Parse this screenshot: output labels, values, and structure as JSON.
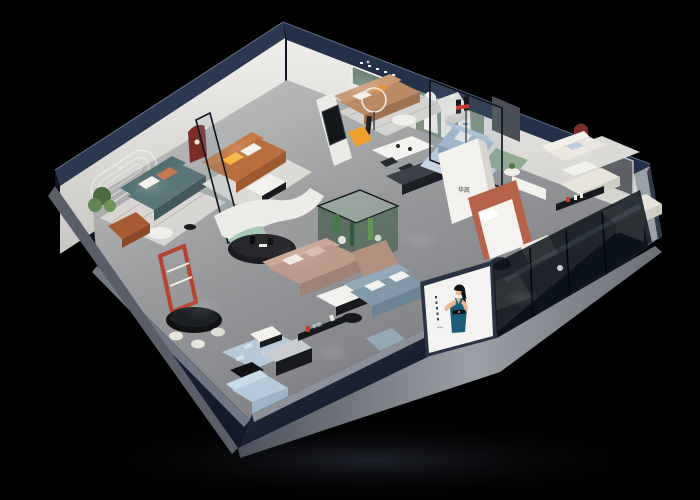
{
  "scene": {
    "type": "3d-isometric-cutaway-render",
    "title": "Furniture brand showroom — isometric cutaway render",
    "background_color": "#000000",
    "floor_color": "#8f9193",
    "exterior_wall_color": "#1d2636",
    "interior_wall_color": "#e9e8e4"
  },
  "brand": {
    "logo_glyph": "H",
    "logo_text": "华凯",
    "logo_red": "#c43b2a",
    "logo_black": "#15181c"
  },
  "banner": {
    "subject": "female model in teal evening dress",
    "background": "#f4f3f1",
    "dress_color": "#1b5d74",
    "has_vertical_caption": true
  },
  "palette": {
    "teal_sofa": "#5a7678",
    "cognac_sofa": "#b96f3d",
    "tan_sofa": "#bb8a64",
    "taupe_sectional": "#bb9a8a",
    "blue_sofa": "#a8bdd6",
    "bluegray_sofa": "#8199a9",
    "cream_sofa": "#e9e6de",
    "green_sofa": "#92ab94",
    "sage_wall": "#7e9183",
    "red_niche": "#7b2e27",
    "terracotta_bed": "#b4634a",
    "orange_accent": "#ef9f2e",
    "mint_bench": "#a8c9b8",
    "light_blue_rug": "#b7c9d8"
  },
  "rooms": [
    {
      "id": "lounge-teal",
      "name": "Teal sofa lounge",
      "items": [
        "teal 3-seat sofa",
        "white round coffee table",
        "cognac armchair",
        "potted plant",
        "striped rug",
        "embossed line wall art"
      ]
    },
    {
      "id": "lounge-cognac",
      "name": "Cognac leather lounge",
      "items": [
        "cognac L-sofa",
        "yellow pillow",
        "marble coffee table",
        "red arched niche",
        "glass partition",
        "sculpture pedestal"
      ]
    },
    {
      "id": "lounge-tan",
      "name": "Tan sofa lounge",
      "items": [
        "tan leather sofa",
        "green recessed niche",
        "ring floor lamp",
        "orange lounge chair",
        "white dining table",
        "black chairs",
        "dark media console",
        "black framed art"
      ]
    },
    {
      "id": "lounge-blue",
      "name": "Arched display lounge",
      "items": [
        "sage wall with 3 white arches",
        "light blue fabric sofa",
        "green loveseat",
        "round side table",
        "glass partition"
      ]
    },
    {
      "id": "lounge-cream-east",
      "name": "East cream lounge",
      "items": [
        "dark red arched niche",
        "cream sofa pair",
        "white coffee table",
        "black wall media shelf",
        "cream corner sectional",
        "gray recessed doorway"
      ]
    },
    {
      "id": "bedroom-terracotta",
      "name": "Terracotta bed vignette",
      "items": [
        "brand logo wall",
        "terracotta bed surround",
        "white bed",
        "black swivel chair",
        "white bench",
        "low display bed"
      ]
    },
    {
      "id": "living-center",
      "name": "Central living display",
      "items": [
        "taupe chaise sectional",
        "marble coffee table",
        "black oval display table",
        "curved white partition",
        "mint curved bench",
        "cactus glass terrarium",
        "blue-gray sofa",
        "pouf",
        "light blue bench"
      ]
    },
    {
      "id": "dining-front",
      "name": "Front dining & media zone",
      "items": [
        "red display shelf",
        "black oval dining table",
        "cream chairs",
        "patterned blue rug",
        "dark media consoles",
        "marble bench",
        "light blue sectional",
        "wall-mounted logo shelf"
      ]
    }
  ],
  "exterior": {
    "front": [
      "navy facade",
      "model poster banner",
      "glass storefront with mullions",
      "silver plinth skirt"
    ],
    "ambience": "black void with recessed spotlight pools"
  }
}
